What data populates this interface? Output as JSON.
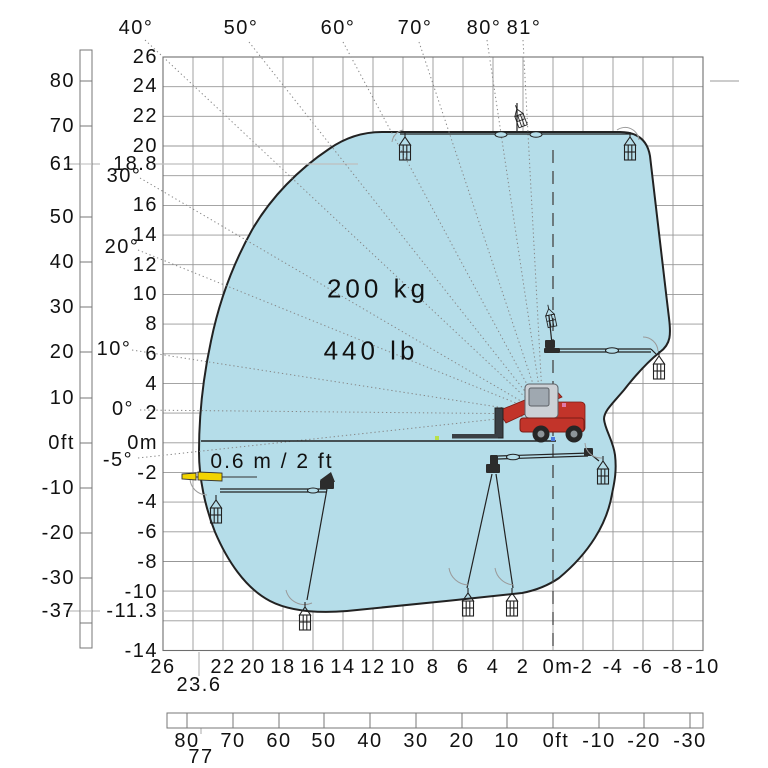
{
  "chart_data": {
    "type": "area",
    "title": "",
    "description": "Working range / load envelope chart of a compact telehandler with winch-hook attachment shown in multiple boom positions",
    "capacity": {
      "kg": "200 kg",
      "lb": "440 lb"
    },
    "annotation": "0.6 m / 2 ft",
    "boom_angle_labels_top": [
      "40°",
      "50°",
      "60°",
      "70°",
      "80°",
      "81°"
    ],
    "boom_angle_labels_left": [
      "30°",
      "20°",
      "10°",
      "0°",
      "-5°"
    ],
    "height_axis_m": [
      "26",
      "24",
      "22",
      "20",
      "18.8",
      "16",
      "14",
      "12",
      "10",
      "8",
      "6",
      "4",
      "2",
      "0m",
      "-2",
      "-4",
      "-6",
      "-8",
      "-10",
      "-11.3",
      "-14"
    ],
    "height_axis_ft": [
      "80",
      "70",
      "61",
      "50",
      "40",
      "30",
      "20",
      "10",
      "0ft",
      "-10",
      "-20",
      "-30",
      "-37"
    ],
    "reach_axis_m": [
      "26",
      "22",
      "20",
      "18",
      "16",
      "14",
      "12",
      "10",
      "8",
      "6",
      "4",
      "2",
      "0m",
      "-2",
      "-4",
      "-6",
      "-8",
      "-10"
    ],
    "reach_axis_m_special": "23.6",
    "reach_axis_ft": [
      "80",
      "70",
      "60",
      "50",
      "40",
      "30",
      "20",
      "10",
      "0ft",
      "-10",
      "-20",
      "-30"
    ],
    "reach_axis_ft_special": "77",
    "envelope_extents": {
      "max_height": "18.8 m / 61 ft",
      "max_depth": "-11.3 m / -37 ft",
      "max_reach": "23.6 m / 77 ft"
    },
    "axis_ranges": {
      "x_m": [
        26,
        -10
      ],
      "y_m": [
        26,
        -14
      ]
    },
    "grid_spacing_m": 2,
    "envelope_outline_m": [
      [
        11.4,
        20.9
      ],
      [
        -4.5,
        20.9
      ],
      [
        -6.5,
        19.3
      ],
      [
        -7.7,
        12.5
      ],
      [
        -7.8,
        8.4
      ],
      [
        -7.1,
        6.1
      ],
      [
        -4.8,
        3.6
      ],
      [
        -4.1,
        1.6
      ],
      [
        -4.2,
        -1.0
      ],
      [
        -4.1,
        -3.5
      ],
      [
        -3.9,
        -7.5
      ],
      [
        -0.5,
        -10.1
      ],
      [
        2.1,
        -10.2
      ],
      [
        13.7,
        -11.3
      ],
      [
        18.9,
        -10.6
      ],
      [
        22.5,
        -6.0
      ],
      [
        23.6,
        -0.6
      ],
      [
        23.5,
        2.0
      ],
      [
        22.8,
        6.9
      ],
      [
        21.4,
        12.0
      ],
      [
        19.4,
        16.3
      ],
      [
        14.9,
        19.8
      ]
    ],
    "colors": {
      "envelope_fill": "#b5dde9",
      "envelope_stroke": "#222222",
      "machine_red": "#c2342a",
      "marker_yellow": "#f2d400"
    }
  },
  "labels": {
    "capacity_kg": "200 kg",
    "capacity_lb": "440 lb",
    "reach_note": "0.6 m / 2 ft"
  },
  "axes": {
    "left_m": [
      "26",
      "24",
      "22",
      "20",
      "18.8",
      "16",
      "14",
      "12",
      "10",
      "8",
      "6",
      "4",
      "2",
      "0m",
      "-2",
      "-4",
      "-6",
      "-8",
      "-10",
      "-11.3",
      "-14"
    ],
    "left_ft": [
      "80",
      "70",
      "61",
      "50",
      "40",
      "30",
      "20",
      "10",
      "0ft",
      "-10",
      "-20",
      "-30",
      "-37"
    ],
    "angles_left": [
      "30°",
      "20°",
      "10°",
      "0°",
      "-5°"
    ],
    "angles_top": [
      "40°",
      "50°",
      "60°",
      "70°",
      "80°",
      "81°"
    ],
    "bottom_m": [
      "26",
      "22",
      "20",
      "18",
      "16",
      "14",
      "12",
      "10",
      "8",
      "6",
      "4",
      "2",
      "0m",
      "-2",
      "-4",
      "-6",
      "-8",
      "-10"
    ],
    "bottom_m_special": "23.6",
    "bottom_ft": [
      "80",
      "70",
      "60",
      "50",
      "40",
      "30",
      "20",
      "10",
      "0ft",
      "-10",
      "-20",
      "-30"
    ],
    "bottom_ft_special": "77"
  }
}
